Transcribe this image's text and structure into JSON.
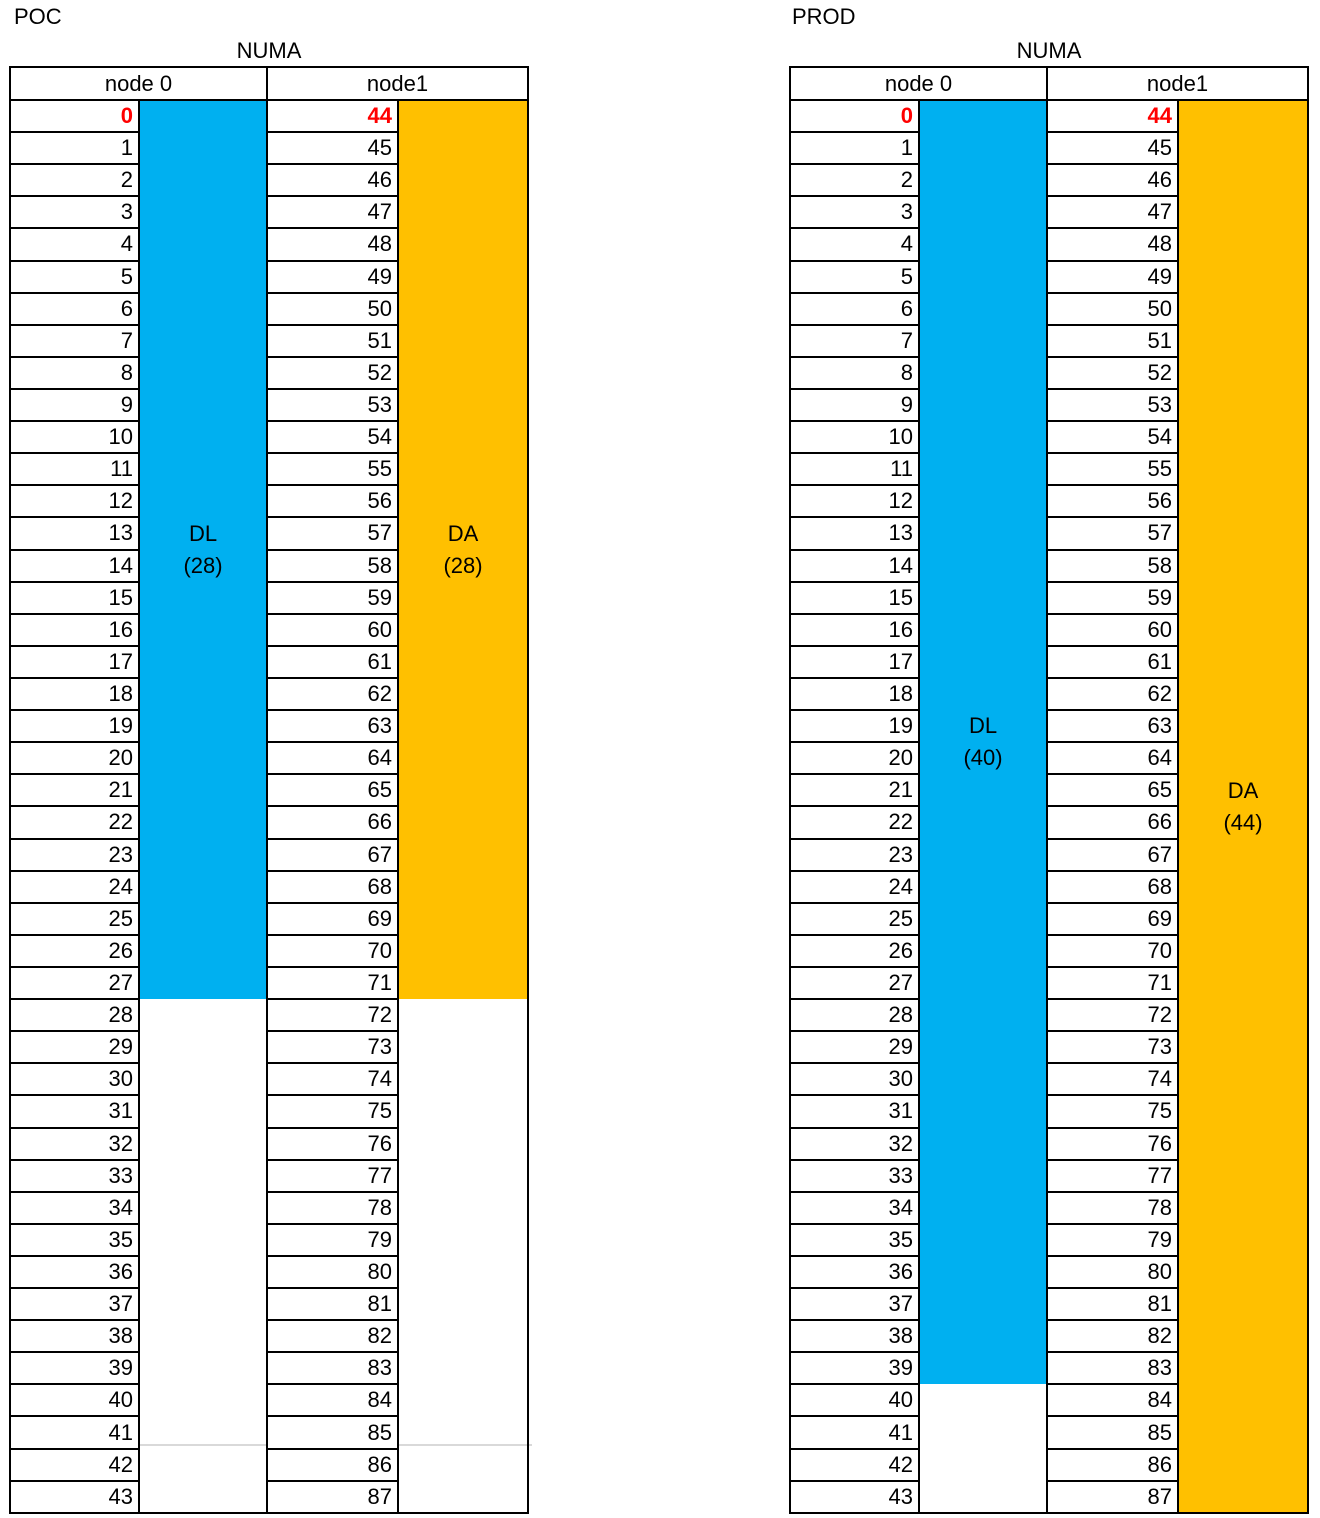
{
  "colors": {
    "dl_fill": "#00B0F0",
    "da_fill": "#FFC000",
    "first_core": "#FF0000",
    "border": "#000000"
  },
  "row_numbers": {
    "node0": [
      0,
      1,
      2,
      3,
      4,
      5,
      6,
      7,
      8,
      9,
      10,
      11,
      12,
      13,
      14,
      15,
      16,
      17,
      18,
      19,
      20,
      21,
      22,
      23,
      24,
      25,
      26,
      27,
      28,
      29,
      30,
      31,
      32,
      33,
      34,
      35,
      36,
      37,
      38,
      39,
      40,
      41,
      42,
      43
    ],
    "node1": [
      44,
      45,
      46,
      47,
      48,
      49,
      50,
      51,
      52,
      53,
      54,
      55,
      56,
      57,
      58,
      59,
      60,
      61,
      62,
      63,
      64,
      65,
      66,
      67,
      68,
      69,
      70,
      71,
      72,
      73,
      74,
      75,
      76,
      77,
      78,
      79,
      80,
      81,
      82,
      83,
      84,
      85,
      86,
      87
    ]
  },
  "tables": [
    {
      "env_label": "POC",
      "title": "NUMA",
      "columns": [
        {
          "header": "node 0",
          "rows_key": "node0",
          "first_value_red": true,
          "block": {
            "label": "DL",
            "count": "(28)",
            "rows": 28,
            "color": "dl_fill"
          }
        },
        {
          "header": "node1",
          "rows_key": "node1",
          "first_value_red": true,
          "block": {
            "label": "DA",
            "count": "(28)",
            "rows": 28,
            "color": "da_fill"
          }
        }
      ]
    },
    {
      "env_label": "PROD",
      "title": "NUMA",
      "columns": [
        {
          "header": "node 0",
          "rows_key": "node0",
          "first_value_red": true,
          "block": {
            "label": "DL",
            "count": "(40)",
            "rows": 40,
            "color": "dl_fill"
          }
        },
        {
          "header": "node1",
          "rows_key": "node1",
          "first_value_red": true,
          "block": {
            "label": "DA",
            "count": "(44)",
            "rows": 44,
            "color": "da_fill"
          }
        }
      ]
    }
  ]
}
